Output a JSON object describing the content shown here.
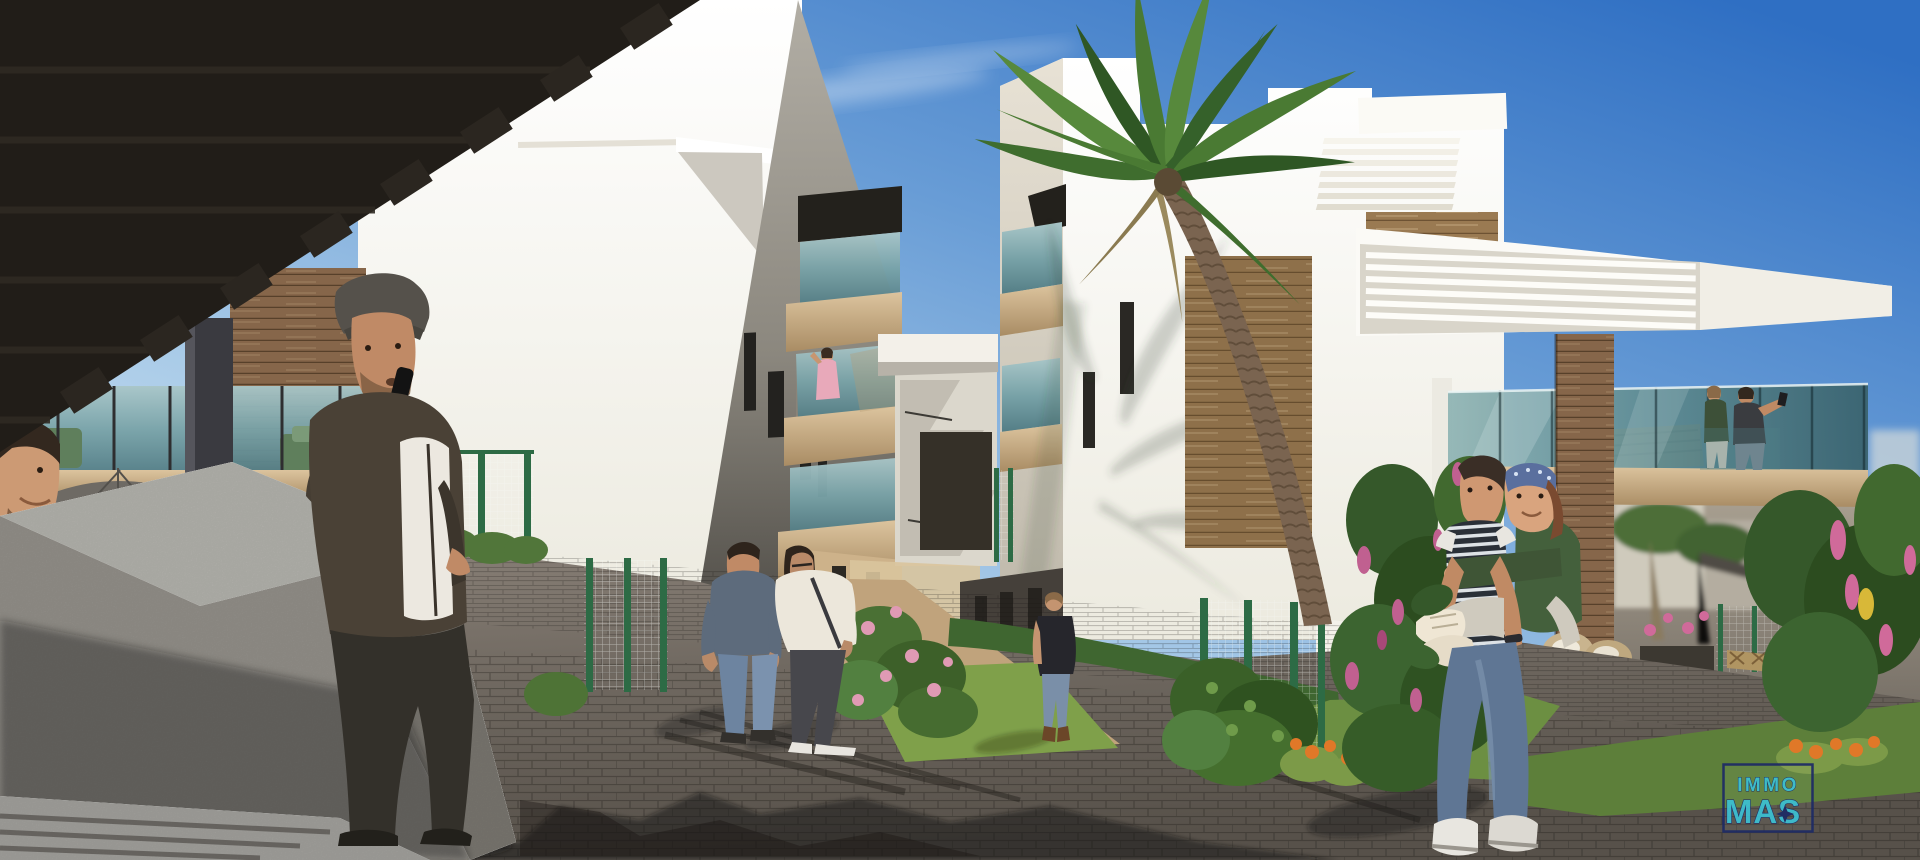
{
  "watermark": {
    "line1": "IMMO",
    "line2": "MAS"
  },
  "palette": {
    "sky_top": "#3372c4",
    "sky_horizon": "#eaf2f8",
    "logo_teal": "#3cc2d4",
    "logo_navy": "#1d2a66",
    "glass_teal": "#5d8f96",
    "balcony_beige": "#c9ad85",
    "wood": "#9a7a52",
    "pergola_dark": "#211d18",
    "grass_green": "#7fa04a",
    "fence_green": "#2d6b45",
    "paver_gray": "#6e675f",
    "concrete_gray": "#96938e"
  }
}
